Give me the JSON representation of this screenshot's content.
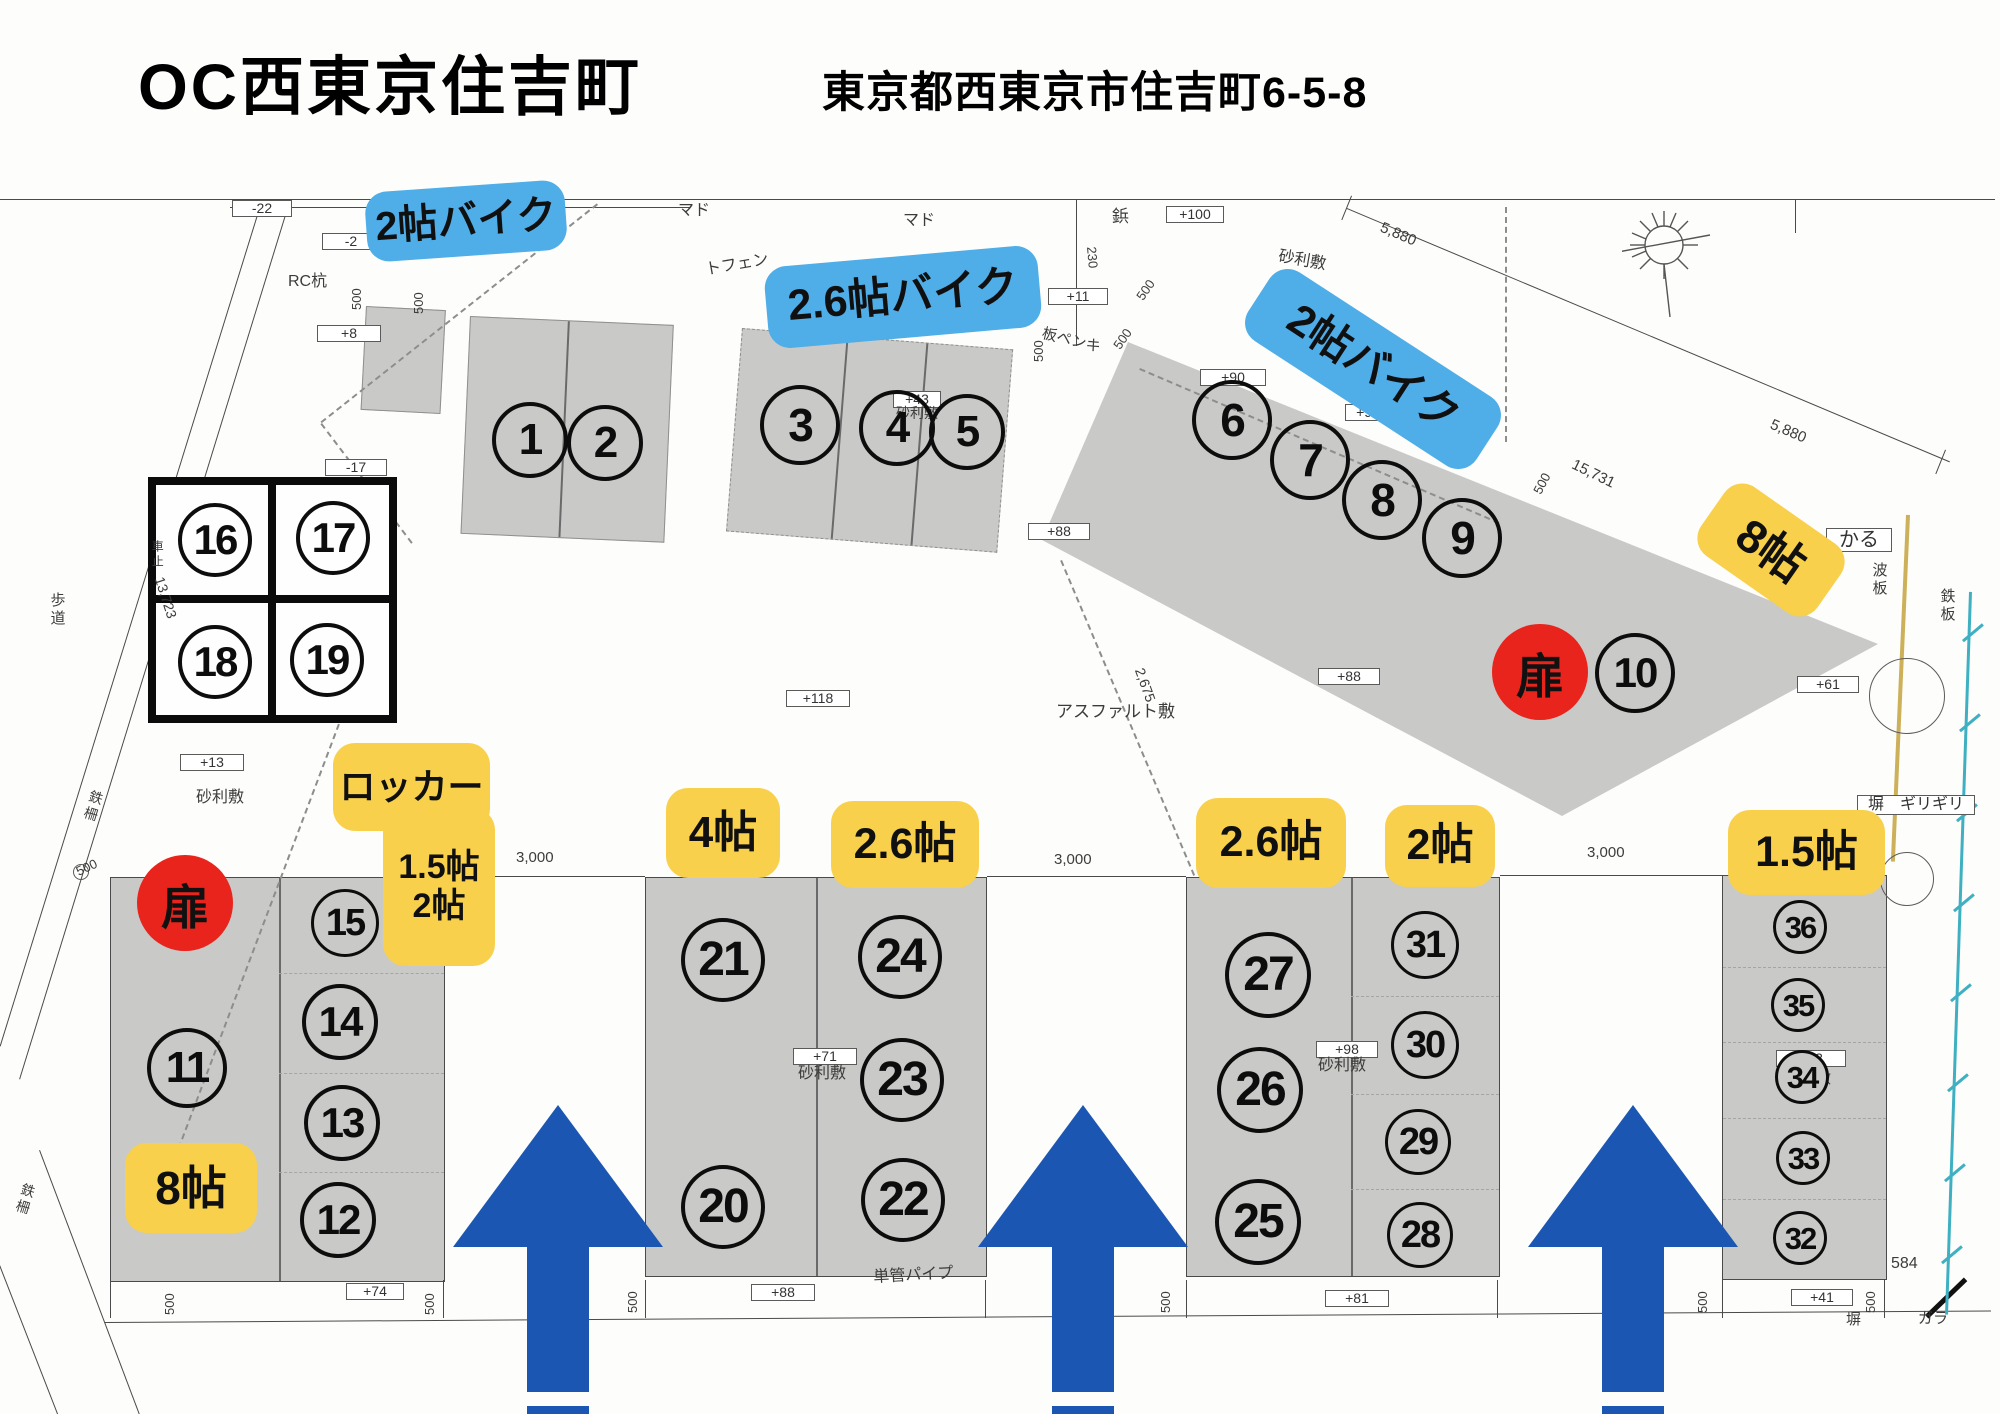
{
  "page": {
    "title": "OC西東京住吉町",
    "address": "東京都西東京市住吉町6-5-8"
  },
  "stickers": [
    {
      "name": "label-bike-2jo-top",
      "color": "blue",
      "x": 366,
      "y": 186,
      "w": 200,
      "h": 70,
      "rot": -4,
      "fs": 40,
      "lines": [
        "2帖バイク"
      ]
    },
    {
      "name": "label-bike-2.6jo",
      "color": "blue",
      "x": 766,
      "y": 256,
      "w": 274,
      "h": 82,
      "rot": -5,
      "fs": 43,
      "lines": [
        "2.6帖バイク"
      ]
    },
    {
      "name": "label-bike-2jo-right",
      "color": "blue",
      "x": 1237,
      "y": 328,
      "w": 272,
      "h": 82,
      "rot": 33,
      "fs": 43,
      "lines": [
        "2帖バイク"
      ]
    },
    {
      "name": "label-8jo-right",
      "color": "yellow",
      "x": 1700,
      "y": 508,
      "w": 142,
      "h": 84,
      "rot": 35,
      "fs": 46,
      "lines": [
        "8帖"
      ]
    },
    {
      "name": "label-locker-title",
      "color": "yellow",
      "x": 333,
      "y": 743,
      "w": 157,
      "h": 88,
      "rot": 0,
      "fs": 36,
      "lines": [
        "ロッカー"
      ]
    },
    {
      "name": "label-locker-sizes",
      "color": "yellow",
      "x": 383,
      "y": 808,
      "w": 112,
      "h": 158,
      "rot": 0,
      "fs": 34,
      "lines": [
        "1.5帖",
        "2帖"
      ]
    },
    {
      "name": "label-8jo-left",
      "color": "yellow",
      "x": 125,
      "y": 1143,
      "w": 132,
      "h": 90,
      "rot": 0,
      "fs": 46,
      "lines": [
        "8帖"
      ]
    },
    {
      "name": "label-4jo",
      "color": "yellow",
      "x": 666,
      "y": 788,
      "w": 114,
      "h": 90,
      "rot": 0,
      "fs": 44,
      "lines": [
        "4帖"
      ]
    },
    {
      "name": "label-2.6jo-a",
      "color": "yellow",
      "x": 831,
      "y": 801,
      "w": 148,
      "h": 87,
      "rot": 0,
      "fs": 43,
      "lines": [
        "2.6帖"
      ]
    },
    {
      "name": "label-2.6jo-b",
      "color": "yellow",
      "x": 1196,
      "y": 798,
      "w": 150,
      "h": 90,
      "rot": 0,
      "fs": 43,
      "lines": [
        "2.6帖"
      ]
    },
    {
      "name": "label-2jo",
      "color": "yellow",
      "x": 1385,
      "y": 805,
      "w": 110,
      "h": 82,
      "rot": 0,
      "fs": 43,
      "lines": [
        "2帖"
      ]
    },
    {
      "name": "label-1.5jo",
      "color": "yellow",
      "x": 1728,
      "y": 810,
      "w": 157,
      "h": 85,
      "rot": 0,
      "fs": 43,
      "lines": [
        "1.5帖"
      ]
    }
  ],
  "doors": [
    {
      "label": "扉",
      "x": 137,
      "y": 855,
      "d": 96
    },
    {
      "label": "扉",
      "x": 1492,
      "y": 624,
      "d": 96
    }
  ],
  "units": [
    {
      "n": "1",
      "x": 530,
      "y": 440,
      "r": 38,
      "fs": 44
    },
    {
      "n": "2",
      "x": 605,
      "y": 443,
      "r": 38,
      "fs": 44
    },
    {
      "n": "3",
      "x": 800,
      "y": 425,
      "r": 40,
      "fs": 46
    },
    {
      "n": "4",
      "x": 897,
      "y": 428,
      "r": 38,
      "fs": 44
    },
    {
      "n": "5",
      "x": 967,
      "y": 432,
      "r": 38,
      "fs": 44
    },
    {
      "n": "6",
      "x": 1232,
      "y": 420,
      "r": 40,
      "fs": 46
    },
    {
      "n": "7",
      "x": 1310,
      "y": 460,
      "r": 40,
      "fs": 46
    },
    {
      "n": "8",
      "x": 1382,
      "y": 500,
      "r": 40,
      "fs": 46
    },
    {
      "n": "9",
      "x": 1462,
      "y": 538,
      "r": 40,
      "fs": 46
    },
    {
      "n": "10",
      "x": 1635,
      "y": 673,
      "r": 40,
      "fs": 42
    },
    {
      "n": "11",
      "x": 187,
      "y": 1068,
      "r": 40,
      "fs": 44
    },
    {
      "n": "12",
      "x": 338,
      "y": 1220,
      "r": 38,
      "fs": 42
    },
    {
      "n": "13",
      "x": 342,
      "y": 1123,
      "r": 38,
      "fs": 42
    },
    {
      "n": "14",
      "x": 340,
      "y": 1022,
      "r": 38,
      "fs": 42
    },
    {
      "n": "15",
      "x": 345,
      "y": 923,
      "r": 34,
      "fs": 38
    },
    {
      "n": "16",
      "x": 215,
      "y": 540,
      "r": 37,
      "fs": 42
    },
    {
      "n": "17",
      "x": 333,
      "y": 538,
      "r": 37,
      "fs": 42
    },
    {
      "n": "18",
      "x": 215,
      "y": 662,
      "r": 37,
      "fs": 42
    },
    {
      "n": "19",
      "x": 327,
      "y": 660,
      "r": 37,
      "fs": 42
    },
    {
      "n": "20",
      "x": 723,
      "y": 1207,
      "r": 42,
      "fs": 48
    },
    {
      "n": "21",
      "x": 723,
      "y": 960,
      "r": 42,
      "fs": 48
    },
    {
      "n": "22",
      "x": 903,
      "y": 1200,
      "r": 42,
      "fs": 48
    },
    {
      "n": "23",
      "x": 902,
      "y": 1080,
      "r": 42,
      "fs": 48
    },
    {
      "n": "24",
      "x": 900,
      "y": 957,
      "r": 42,
      "fs": 48
    },
    {
      "n": "25",
      "x": 1258,
      "y": 1222,
      "r": 43,
      "fs": 48
    },
    {
      "n": "26",
      "x": 1260,
      "y": 1090,
      "r": 43,
      "fs": 48
    },
    {
      "n": "27",
      "x": 1268,
      "y": 975,
      "r": 43,
      "fs": 48
    },
    {
      "n": "28",
      "x": 1420,
      "y": 1235,
      "r": 33,
      "fs": 38
    },
    {
      "n": "29",
      "x": 1418,
      "y": 1142,
      "r": 33,
      "fs": 38
    },
    {
      "n": "30",
      "x": 1425,
      "y": 1045,
      "r": 34,
      "fs": 38
    },
    {
      "n": "31",
      "x": 1425,
      "y": 945,
      "r": 34,
      "fs": 38
    },
    {
      "n": "32",
      "x": 1800,
      "y": 1238,
      "r": 27,
      "fs": 31
    },
    {
      "n": "33",
      "x": 1803,
      "y": 1158,
      "r": 27,
      "fs": 31
    },
    {
      "n": "34",
      "x": 1802,
      "y": 1077,
      "r": 27,
      "fs": 31,
      "bg": 1
    },
    {
      "n": "35",
      "x": 1798,
      "y": 1005,
      "r": 27,
      "fs": 31
    },
    {
      "n": "36",
      "x": 1800,
      "y": 927,
      "r": 27,
      "fs": 31
    }
  ],
  "annotations": [
    {
      "t": "-22",
      "x": 232,
      "y": 200,
      "b": 1,
      "w": 60
    },
    {
      "t": "-2",
      "x": 322,
      "y": 233,
      "b": 1,
      "w": 58
    },
    {
      "t": "+8",
      "x": 317,
      "y": 325,
      "b": 1,
      "w": 64
    },
    {
      "t": "-17",
      "x": 325,
      "y": 459,
      "b": 1,
      "w": 62
    },
    {
      "t": "+13",
      "x": 180,
      "y": 754,
      "b": 1,
      "w": 64
    },
    {
      "t": "+100",
      "x": 1166,
      "y": 206,
      "b": 1,
      "w": 58
    },
    {
      "t": "+11",
      "x": 1048,
      "y": 288,
      "b": 1,
      "w": 60
    },
    {
      "t": "+90",
      "x": 1200,
      "y": 369,
      "b": 1,
      "w": 66
    },
    {
      "t": "+93",
      "x": 1345,
      "y": 404,
      "b": 1,
      "w": 46
    },
    {
      "t": "+43",
      "x": 893,
      "y": 391,
      "b": 1,
      "w": 48
    },
    {
      "t": "+61",
      "x": 1797,
      "y": 676,
      "b": 1,
      "w": 62
    },
    {
      "t": "+88",
      "x": 1028,
      "y": 523,
      "b": 1,
      "w": 62
    },
    {
      "t": "+88",
      "x": 1318,
      "y": 668,
      "b": 1,
      "w": 62
    },
    {
      "t": "+118",
      "x": 786,
      "y": 690,
      "b": 1,
      "w": 64
    },
    {
      "t": "+71",
      "x": 793,
      "y": 1048,
      "b": 1,
      "w": 64
    },
    {
      "t": "+98",
      "x": 1316,
      "y": 1041,
      "b": 1,
      "w": 62
    },
    {
      "t": "+33",
      "x": 1776,
      "y": 1050,
      "b": 1,
      "w": 70
    },
    {
      "t": "+74",
      "x": 346,
      "y": 1283,
      "b": 1,
      "w": 58
    },
    {
      "t": "+88",
      "x": 751,
      "y": 1284,
      "b": 1,
      "w": 64
    },
    {
      "t": "+81",
      "x": 1325,
      "y": 1290,
      "b": 1,
      "w": 64
    },
    {
      "t": "+41",
      "x": 1791,
      "y": 1289,
      "b": 1,
      "w": 62
    },
    {
      "t": "かる",
      "x": 1826,
      "y": 528,
      "b": 1,
      "w": 66,
      "fs": 20
    },
    {
      "t": "塀　ギリギリ",
      "x": 1857,
      "y": 795,
      "b": 1,
      "w": 118,
      "fs": 16
    },
    {
      "t": "マド",
      "x": 678,
      "y": 202,
      "fs": 16
    },
    {
      "t": "マド",
      "x": 903,
      "y": 212,
      "fs": 16
    },
    {
      "t": "トフェン",
      "x": 704,
      "y": 262,
      "fs": 16,
      "r": -10
    },
    {
      "t": "鋲",
      "x": 1112,
      "y": 208,
      "fs": 17
    },
    {
      "t": "RC杭",
      "x": 288,
      "y": 273,
      "fs": 16
    },
    {
      "t": "歩道",
      "x": 48,
      "y": 592,
      "fs": 15,
      "v": 1
    },
    {
      "t": "車止",
      "x": 150,
      "y": 540,
      "fs": 12,
      "v": 1
    },
    {
      "t": "砂利敷",
      "x": 196,
      "y": 789,
      "fs": 16
    },
    {
      "t": "砂利敷",
      "x": 896,
      "y": 406,
      "fs": 14
    },
    {
      "t": "砂利敷",
      "x": 1280,
      "y": 248,
      "fs": 16,
      "r": 10
    },
    {
      "t": "砂利敷",
      "x": 798,
      "y": 1065,
      "fs": 16
    },
    {
      "t": "砂利敷",
      "x": 1318,
      "y": 1057,
      "fs": 16
    },
    {
      "t": "砂利敷",
      "x": 1786,
      "y": 1071,
      "fs": 15
    },
    {
      "t": "アスファルト敷",
      "x": 1056,
      "y": 703,
      "fs": 17
    },
    {
      "t": "単管パイプ",
      "x": 873,
      "y": 1269,
      "fs": 16,
      "r": -3
    },
    {
      "t": "板ペンキ",
      "x": 1044,
      "y": 326,
      "fs": 15,
      "r": 14
    },
    {
      "t": "波板",
      "x": 1870,
      "y": 562,
      "fs": 15,
      "v": 1
    },
    {
      "t": "鉄板",
      "x": 1938,
      "y": 588,
      "fs": 15,
      "v": 1
    },
    {
      "t": "鉄柵",
      "x": 90,
      "y": 788,
      "fs": 14,
      "v": 1,
      "r": 17
    },
    {
      "t": "鉄柵",
      "x": 22,
      "y": 1181,
      "fs": 14,
      "v": 1,
      "r": 17
    },
    {
      "t": "塀",
      "x": 1846,
      "y": 1312,
      "fs": 15
    },
    {
      "t": "ガラ",
      "x": 1918,
      "y": 1311,
      "fs": 15
    },
    {
      "t": "584",
      "x": 1891,
      "y": 1255,
      "fs": 16
    },
    {
      "t": "5,880",
      "x": 1384,
      "y": 220,
      "fs": 15,
      "r": 23
    },
    {
      "t": "5,880",
      "x": 1774,
      "y": 417,
      "fs": 15,
      "r": 23
    },
    {
      "t": "15,731",
      "x": 1576,
      "y": 457,
      "fs": 15,
      "r": 26
    },
    {
      "t": "13,723",
      "x": 166,
      "y": 575,
      "fs": 14,
      "r": 72
    },
    {
      "t": "3,000",
      "x": 516,
      "y": 850,
      "fs": 15
    },
    {
      "t": "3,000",
      "x": 1054,
      "y": 852,
      "fs": 15
    },
    {
      "t": "3,000",
      "x": 1587,
      "y": 845,
      "fs": 15
    },
    {
      "t": "2,675",
      "x": 1146,
      "y": 666,
      "fs": 14,
      "r": 70
    },
    {
      "t": "230",
      "x": 1098,
      "y": 246,
      "fs": 13,
      "r": 85
    },
    {
      "t": "500",
      "x": 350,
      "y": 310,
      "fs": 13,
      "r": -90
    },
    {
      "t": "500",
      "x": 412,
      "y": 314,
      "fs": 13,
      "r": -90
    },
    {
      "t": "500",
      "x": 1032,
      "y": 362,
      "fs": 13,
      "r": -90
    },
    {
      "t": "500",
      "x": 1134,
      "y": 295,
      "fs": 13,
      "r": -55
    },
    {
      "t": "500",
      "x": 1111,
      "y": 344,
      "fs": 13,
      "r": -55
    },
    {
      "t": "500",
      "x": 1531,
      "y": 490,
      "fs": 13,
      "r": -62
    },
    {
      "t": "500",
      "x": 74,
      "y": 866,
      "fs": 13,
      "r": -25
    },
    {
      "t": "500",
      "x": 163,
      "y": 1315,
      "fs": 13,
      "r": -90
    },
    {
      "t": "500",
      "x": 423,
      "y": 1315,
      "fs": 13,
      "r": -90
    },
    {
      "t": "500",
      "x": 626,
      "y": 1313,
      "fs": 13,
      "r": -90
    },
    {
      "t": "500",
      "x": 1159,
      "y": 1313,
      "fs": 13,
      "r": -90
    },
    {
      "t": "500",
      "x": 1696,
      "y": 1313,
      "fs": 13,
      "r": -90
    },
    {
      "t": "500",
      "x": 1864,
      "y": 1313,
      "fs": 13,
      "r": -90
    }
  ],
  "arrows": [
    {
      "x": 558
    },
    {
      "x": 1083
    },
    {
      "x": 1633
    }
  ],
  "colors": {
    "sticker_blue": "#4fade8",
    "sticker_yellow": "#f8d04b",
    "door_red": "#e8241c",
    "arrow_blue": "#1b57b2",
    "parcel_gray": "#c9c9c7",
    "teal_boundary": "#3fb0c2",
    "yellow_boundary": "#cdb05a"
  }
}
